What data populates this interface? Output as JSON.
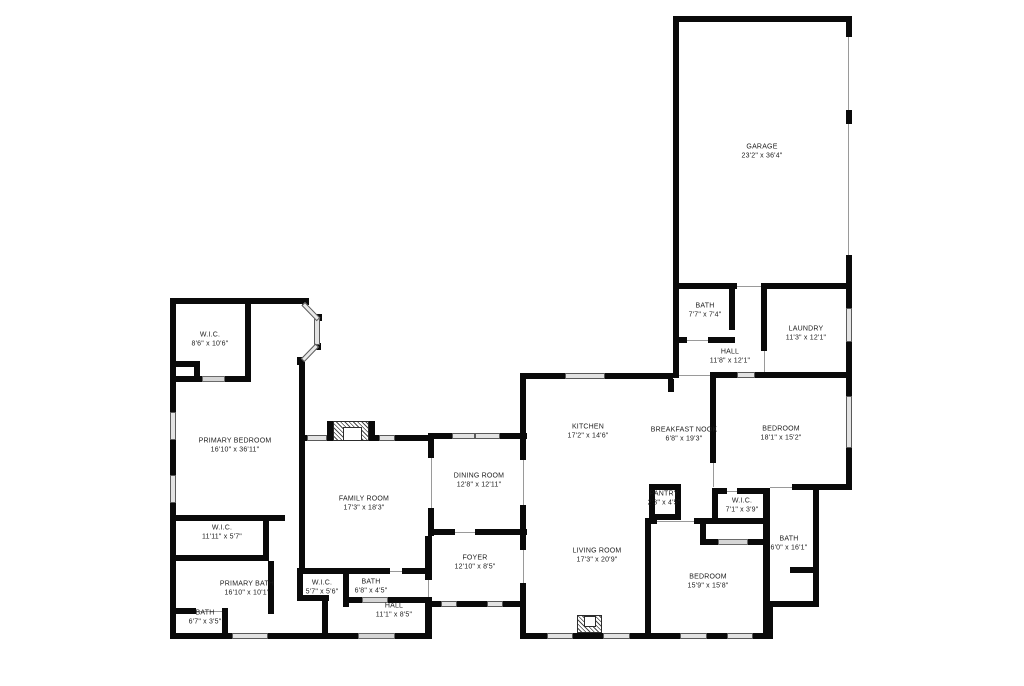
{
  "page": {
    "background": "#ffffff",
    "wall_color": "#0a0a0a",
    "window_color": "#e3e3e3"
  },
  "rooms": [
    {
      "id": "garage",
      "name": "GARAGE",
      "dims": "23'2\" x 36'4\"",
      "x": 762,
      "y": 152
    },
    {
      "id": "bath-upper",
      "name": "BATH",
      "dims": "7'7\" x 7'4\"",
      "x": 705,
      "y": 311
    },
    {
      "id": "laundry",
      "name": "LAUNDRY",
      "dims": "11'3\" x 12'1\"",
      "x": 806,
      "y": 334
    },
    {
      "id": "hall-upper",
      "name": "HALL",
      "dims": "11'8\" x 12'1\"",
      "x": 730,
      "y": 357
    },
    {
      "id": "wic-top-left",
      "name": "W.I.C.",
      "dims": "8'6\" x 10'6\"",
      "x": 210,
      "y": 340
    },
    {
      "id": "primary-bedroom",
      "name": "PRIMARY BEDROOM",
      "dims": "16'10\" x 36'11\"",
      "x": 235,
      "y": 446
    },
    {
      "id": "kitchen",
      "name": "KITCHEN",
      "dims": "17'2\" x 14'6\"",
      "x": 588,
      "y": 432
    },
    {
      "id": "breakfast-nook",
      "name": "BREAKFAST NOOK",
      "dims": "6'8\" x 19'3\"",
      "x": 684,
      "y": 435
    },
    {
      "id": "bedroom-ne",
      "name": "BEDROOM",
      "dims": "18'1\" x 15'2\"",
      "x": 781,
      "y": 434
    },
    {
      "id": "dining-room",
      "name": "DINING ROOM",
      "dims": "12'8\" x 12'11\"",
      "x": 479,
      "y": 481
    },
    {
      "id": "family-room",
      "name": "FAMILY ROOM",
      "dims": "17'3\" x 18'3\"",
      "x": 364,
      "y": 504
    },
    {
      "id": "pantry",
      "name": "PANTRY",
      "dims": "2'3\" x 4'5\"",
      "x": 664,
      "y": 499
    },
    {
      "id": "wic-center",
      "name": "W.I.C.",
      "dims": "7'1\" x 3'9\"",
      "x": 742,
      "y": 506
    },
    {
      "id": "bath-east",
      "name": "BATH",
      "dims": "6'0\" x 16'1\"",
      "x": 789,
      "y": 544
    },
    {
      "id": "wic-west",
      "name": "W.I.C.",
      "dims": "11'11\" x 5'7\"",
      "x": 222,
      "y": 533
    },
    {
      "id": "foyer",
      "name": "FOYER",
      "dims": "12'10\" x 8'5\"",
      "x": 475,
      "y": 563
    },
    {
      "id": "living-room",
      "name": "LIVING ROOM",
      "dims": "17'3\" x 20'9\"",
      "x": 597,
      "y": 556
    },
    {
      "id": "wic-small",
      "name": "W.I.C.",
      "dims": "5'7\" x 5'6\"",
      "x": 322,
      "y": 588
    },
    {
      "id": "bath-hall",
      "name": "BATH",
      "dims": "6'8\" x 4'5\"",
      "x": 371,
      "y": 587
    },
    {
      "id": "primary-bath",
      "name": "PRIMARY BATH",
      "dims": "16'10\" x 10'1\"",
      "x": 247,
      "y": 589
    },
    {
      "id": "bedroom-se",
      "name": "BEDROOM",
      "dims": "15'9\" x 15'8\"",
      "x": 708,
      "y": 582
    },
    {
      "id": "bath-sw",
      "name": "BATH",
      "dims": "6'7\" x 3'5\"",
      "x": 205,
      "y": 618
    },
    {
      "id": "hall-lower",
      "name": "HALL",
      "dims": "11'1\" x 8'5\"",
      "x": 394,
      "y": 611
    }
  ]
}
